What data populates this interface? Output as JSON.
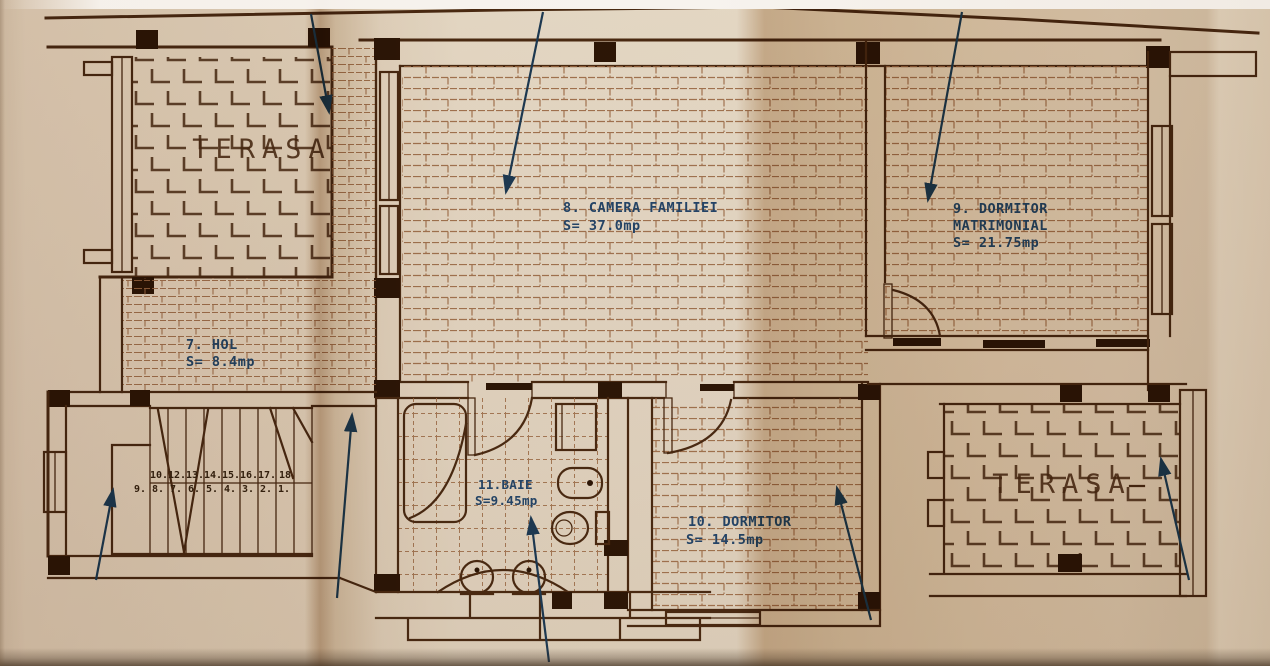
{
  "rooms": {
    "terasa_top": {
      "label": "TERASA"
    },
    "camera_familiei": {
      "line1": "8. CAMERA FAMILIEI",
      "line2": "S= 37.0mp"
    },
    "dormitor_matrimonial": {
      "line1": "9. DORMITOR",
      "line2": "MATRIMONIAL",
      "line3": "S= 21.75mp"
    },
    "hol": {
      "line1": "7. HOL",
      "line2": "S= 8.4mp"
    },
    "baie": {
      "line1": "11.BAIE",
      "line2": "S=9.45mp"
    },
    "dormitor": {
      "line1": "10. DORMITOR",
      "line2": "S= 14.5mp"
    },
    "terasa_bottom": {
      "label": "TERASA"
    }
  },
  "stairs": {
    "upper_flight_numbers": [
      "10.",
      "12.",
      "13.",
      "14.",
      "15.",
      "16.",
      "17.",
      "18"
    ],
    "lower_flight_numbers": [
      "9.",
      "8.",
      "7.",
      "6.",
      "5.",
      "4.",
      "3.",
      "2.",
      "1."
    ]
  },
  "colors": {
    "paper": "#e2d6c7",
    "ink": "#4a2a12",
    "ink_dark": "#2d1606",
    "hatch": "#9a6a45",
    "label_blue": "#24456b",
    "arrow_blue": "#1d3a55"
  }
}
